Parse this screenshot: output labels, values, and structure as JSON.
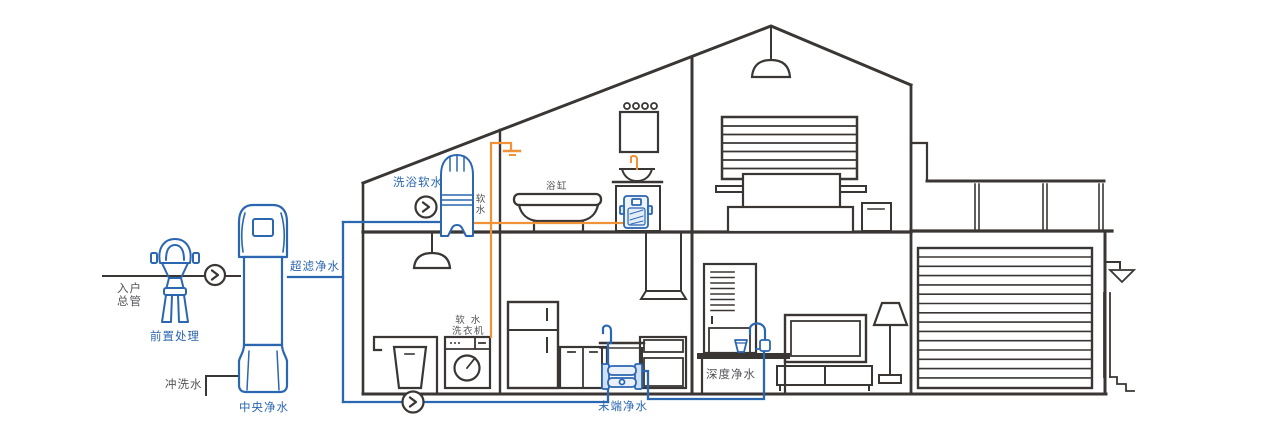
{
  "diagram": {
    "title": "whole-house water purification cutaway",
    "colors": {
      "line_dark": "#3a3634",
      "pipe_blue": "#2b66b1",
      "pipe_orange": "#ef9238",
      "label_blue": "#2b66b1",
      "label_dark": "#515356"
    },
    "labels": {
      "entry_main_line1": "入户",
      "entry_main_line2": "总管",
      "pre_treatment": "前置处理",
      "flush_water": "冲洗水",
      "central_purification": "中央净水",
      "ultrafiltration": "超滤净水",
      "bath_softening": "洗浴软水",
      "soft_water_char1": "软",
      "soft_water_char2": "水",
      "bathtub": "浴缸",
      "softwater_washer_line1": "软 水",
      "softwater_washer_line2": "洗衣机",
      "terminal_purification": "末端净水",
      "deep_purification": "深度净水"
    }
  }
}
